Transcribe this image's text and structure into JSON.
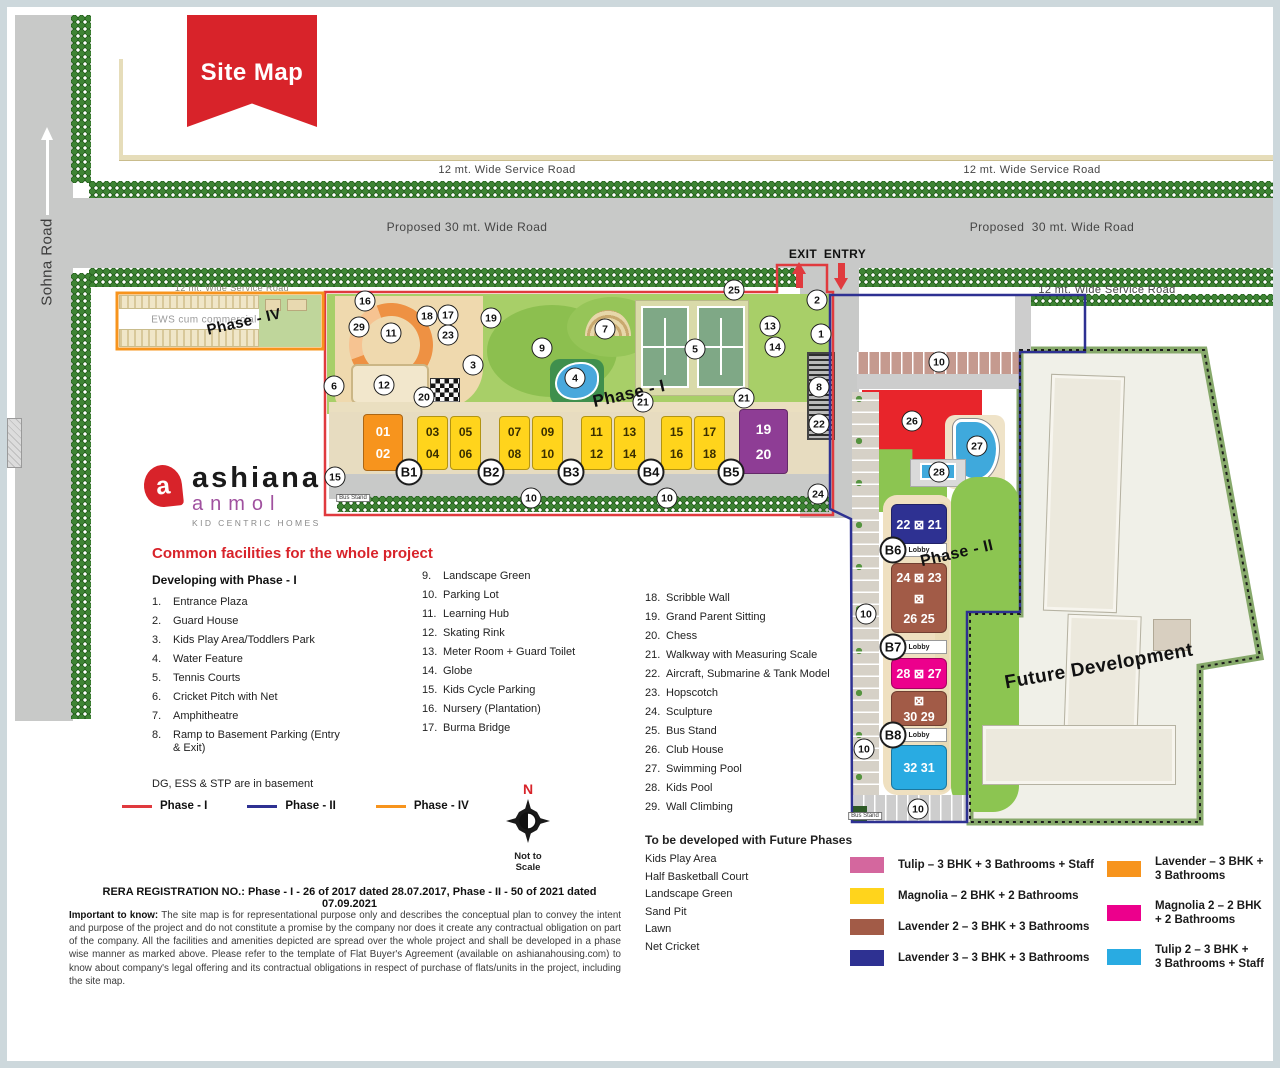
{
  "banner": {
    "title": "Site Map"
  },
  "colors": {
    "phase1_border": "#E03A3E",
    "phase2_border": "#2E3192",
    "phase4_border": "#F7941D",
    "road": "#C8C9C8",
    "club_house_red": "#E8252B",
    "pool_blue": "#3FA9DC"
  },
  "map": {
    "labels": [
      {
        "t": "12 mt. Wide Service Road",
        "x": 500,
        "y": 163,
        "s": 11,
        "c": "#454545"
      },
      {
        "t": "12 mt. Wide Service Road",
        "x": 1025,
        "y": 163,
        "s": 11,
        "c": "#454545"
      },
      {
        "t": "Proposed 30 mt. Wide Road",
        "x": 460,
        "y": 220,
        "s": 12,
        "c": "#454545"
      },
      {
        "t": "Proposed  30 mt. Wide Road",
        "x": 1045,
        "y": 220,
        "s": 12,
        "c": "#454545"
      },
      {
        "t": "12 mt. Wide Service Road",
        "x": 225,
        "y": 281,
        "s": 9,
        "c": "#8a8a76"
      },
      {
        "t": "12 mt. Wide Service Road",
        "x": 1100,
        "y": 283,
        "s": 11,
        "c": "#454545"
      },
      {
        "t": "Sohna Road",
        "x": 40,
        "y": 255,
        "s": 15,
        "c": "#3c3c3c",
        "rot": -90
      },
      {
        "t": "EXIT",
        "x": 796,
        "y": 247,
        "s": 12,
        "c": "#111",
        "w": 800
      },
      {
        "t": "ENTRY",
        "x": 838,
        "y": 247,
        "s": 12,
        "c": "#111",
        "w": 800
      },
      {
        "t": "EWS cum commercial",
        "x": 197,
        "y": 313,
        "s": 10,
        "c": "#9a9a9a"
      },
      {
        "t": "Phase - IV",
        "x": 237,
        "y": 315,
        "s": 15,
        "c": "#111",
        "rot": -13,
        "w": 800
      },
      {
        "t": "Phase - I",
        "x": 622,
        "y": 387,
        "s": 17,
        "c": "#111",
        "rot": -13,
        "w": 800
      },
      {
        "t": "Phase - II",
        "x": 950,
        "y": 547,
        "s": 16,
        "c": "#111",
        "rot": -13,
        "w": 800
      },
      {
        "t": "Future Development",
        "x": 1092,
        "y": 660,
        "s": 19,
        "c": "#111",
        "rot": -10,
        "w": 800
      },
      {
        "t": "Bus Stand",
        "x": 346,
        "y": 491,
        "s": 6,
        "c": "#333",
        "box": true
      },
      {
        "t": "Bus Stand",
        "x": 858,
        "y": 809,
        "s": 6,
        "c": "#333",
        "box": true
      }
    ],
    "circles": [
      {
        "n": "16",
        "x": 358,
        "y": 294
      },
      {
        "n": "29",
        "x": 352,
        "y": 320
      },
      {
        "n": "11",
        "x": 384,
        "y": 326
      },
      {
        "n": "18",
        "x": 420,
        "y": 309
      },
      {
        "n": "17",
        "x": 441,
        "y": 308
      },
      {
        "n": "23",
        "x": 441,
        "y": 328
      },
      {
        "n": "19",
        "x": 484,
        "y": 311
      },
      {
        "n": "3",
        "x": 466,
        "y": 358
      },
      {
        "n": "6",
        "x": 327,
        "y": 379
      },
      {
        "n": "12",
        "x": 377,
        "y": 378
      },
      {
        "n": "20",
        "x": 417,
        "y": 390
      },
      {
        "n": "15",
        "x": 328,
        "y": 470
      },
      {
        "n": "7",
        "x": 598,
        "y": 322
      },
      {
        "n": "9",
        "x": 535,
        "y": 341
      },
      {
        "n": "4",
        "x": 568,
        "y": 371
      },
      {
        "n": "5",
        "x": 688,
        "y": 342
      },
      {
        "n": "25",
        "x": 727,
        "y": 283
      },
      {
        "n": "13",
        "x": 763,
        "y": 319
      },
      {
        "n": "14",
        "x": 768,
        "y": 340
      },
      {
        "n": "2",
        "x": 810,
        "y": 293
      },
      {
        "n": "1",
        "x": 814,
        "y": 327
      },
      {
        "n": "8",
        "x": 812,
        "y": 380
      },
      {
        "n": "21",
        "x": 636,
        "y": 395
      },
      {
        "n": "21",
        "x": 737,
        "y": 391
      },
      {
        "n": "22",
        "x": 812,
        "y": 417
      },
      {
        "n": "24",
        "x": 811,
        "y": 487
      },
      {
        "n": "10",
        "x": 524,
        "y": 491
      },
      {
        "n": "10",
        "x": 660,
        "y": 491
      },
      {
        "n": "10",
        "x": 932,
        "y": 355
      },
      {
        "n": "10",
        "x": 859,
        "y": 607
      },
      {
        "n": "10",
        "x": 857,
        "y": 742
      },
      {
        "n": "10",
        "x": 911,
        "y": 802
      },
      {
        "n": "26",
        "x": 905,
        "y": 414
      },
      {
        "n": "27",
        "x": 970,
        "y": 439
      },
      {
        "n": "28",
        "x": 932,
        "y": 465
      }
    ],
    "bcircles": [
      {
        "n": "B1",
        "x": 402,
        "y": 465
      },
      {
        "n": "B2",
        "x": 484,
        "y": 465
      },
      {
        "n": "B3",
        "x": 564,
        "y": 465
      },
      {
        "n": "B4",
        "x": 644,
        "y": 465
      },
      {
        "n": "B5",
        "x": 724,
        "y": 465
      },
      {
        "n": "B6",
        "x": 886,
        "y": 543
      },
      {
        "n": "B7",
        "x": 886,
        "y": 640
      },
      {
        "n": "B8",
        "x": 886,
        "y": 728
      }
    ],
    "towers_phase1": [
      {
        "x": 356,
        "y": 407,
        "w": 40,
        "h": 57,
        "bg": "#F7941D",
        "fg": "#ffffff",
        "fs": 13,
        "labels": [
          "01",
          "02"
        ]
      },
      {
        "x": 410,
        "y": 409,
        "w": 31,
        "h": 54,
        "bg": "#FFD41C",
        "fg": "#3a2f00",
        "fs": 12,
        "labels": [
          "03",
          "04"
        ]
      },
      {
        "x": 443,
        "y": 409,
        "w": 31,
        "h": 54,
        "bg": "#FFD41C",
        "fg": "#3a2f00",
        "fs": 12,
        "labels": [
          "05",
          "06"
        ]
      },
      {
        "x": 492,
        "y": 409,
        "w": 31,
        "h": 54,
        "bg": "#FFD41C",
        "fg": "#3a2f00",
        "fs": 12,
        "labels": [
          "07",
          "08"
        ]
      },
      {
        "x": 525,
        "y": 409,
        "w": 31,
        "h": 54,
        "bg": "#FFD41C",
        "fg": "#3a2f00",
        "fs": 12,
        "labels": [
          "09",
          "10"
        ]
      },
      {
        "x": 574,
        "y": 409,
        "w": 31,
        "h": 54,
        "bg": "#FFD41C",
        "fg": "#3a2f00",
        "fs": 12,
        "labels": [
          "11",
          "12"
        ]
      },
      {
        "x": 607,
        "y": 409,
        "w": 31,
        "h": 54,
        "bg": "#FFD41C",
        "fg": "#3a2f00",
        "fs": 12,
        "labels": [
          "13",
          "14"
        ]
      },
      {
        "x": 654,
        "y": 409,
        "w": 31,
        "h": 54,
        "bg": "#FFD41C",
        "fg": "#3a2f00",
        "fs": 12,
        "labels": [
          "15",
          "16"
        ]
      },
      {
        "x": 687,
        "y": 409,
        "w": 31,
        "h": 54,
        "bg": "#FFD41C",
        "fg": "#3a2f00",
        "fs": 12,
        "labels": [
          "17",
          "18"
        ]
      },
      {
        "x": 732,
        "y": 402,
        "w": 49,
        "h": 65,
        "bg": "#8E3D95",
        "fg": "#ffffff",
        "fs": 14,
        "labels": [
          "19",
          "20"
        ]
      }
    ],
    "cores_x": [
      396,
      474,
      556,
      638,
      718
    ],
    "towers_phase2": [
      {
        "y": 497,
        "h": 40,
        "bg": "#2E3192",
        "rows": [
          "22 ⊠ 21"
        ]
      },
      {
        "y": 556,
        "h": 70,
        "bg": "#A25B47",
        "rows": [
          "24 ⊠ 23",
          "⊠",
          "26  25"
        ]
      },
      {
        "y": 651,
        "h": 31,
        "bg": "#EC008C",
        "rows": [
          "28 ⊠ 27"
        ]
      },
      {
        "y": 684,
        "h": 35,
        "bg": "#A25B47",
        "rows": [
          "⊠",
          "30  29"
        ]
      },
      {
        "y": 738,
        "h": 45,
        "bg": "#29ABE2",
        "rows": [
          "32  31"
        ]
      }
    ],
    "lobbies": [
      {
        "y": 536,
        "label": "Lobby"
      },
      {
        "y": 633,
        "label": "Lobby"
      },
      {
        "y": 721,
        "label": "Lobby"
      }
    ]
  },
  "facilities": {
    "title": "Common facilities for the whole project",
    "col1_header": "Developing with Phase - I",
    "col1": [
      {
        "n": "1.",
        "t": "Entrance Plaza"
      },
      {
        "n": "2.",
        "t": "Guard House"
      },
      {
        "n": "3.",
        "t": "Kids Play Area/Toddlers Park"
      },
      {
        "n": "4.",
        "t": "Water Feature"
      },
      {
        "n": "5.",
        "t": "Tennis Courts"
      },
      {
        "n": "6.",
        "t": "Cricket Pitch with Net"
      },
      {
        "n": "7.",
        "t": "Amphitheatre"
      },
      {
        "n": "8.",
        "t": "Ramp to Basement Parking (Entry & Exit)"
      }
    ],
    "col2": [
      {
        "n": "9.",
        "t": "Landscape Green"
      },
      {
        "n": "10.",
        "t": "Parking Lot"
      },
      {
        "n": "11.",
        "t": "Learning Hub"
      },
      {
        "n": "12.",
        "t": "Skating Rink"
      },
      {
        "n": "13.",
        "t": "Meter Room + Guard Toilet"
      },
      {
        "n": "14.",
        "t": "Globe"
      },
      {
        "n": "15.",
        "t": "Kids Cycle Parking"
      },
      {
        "n": "16.",
        "t": "Nursery (Plantation)"
      },
      {
        "n": "17.",
        "t": "Burma Bridge"
      }
    ],
    "col3": [
      {
        "n": "18.",
        "t": "Scribble Wall"
      },
      {
        "n": "19.",
        "t": "Grand Parent Sitting"
      },
      {
        "n": "20.",
        "t": "Chess"
      },
      {
        "n": "21.",
        "t": "Walkway with Measuring Scale"
      },
      {
        "n": "22.",
        "t": "Aircraft, Submarine & Tank Model"
      },
      {
        "n": "23.",
        "t": "Hopscotch"
      },
      {
        "n": "24.",
        "t": "Sculpture"
      },
      {
        "n": "25.",
        "t": "Bus Stand"
      },
      {
        "n": "26.",
        "t": "Club House"
      },
      {
        "n": "27.",
        "t": "Swimming Pool"
      },
      {
        "n": "28.",
        "t": "Kids Pool"
      },
      {
        "n": "29.",
        "t": "Wall Climbing"
      }
    ],
    "basement_note": "DG, ESS & STP are in basement"
  },
  "phase_lines": [
    {
      "label": "Phase - I",
      "color": "#E03A3E"
    },
    {
      "label": "Phase - II",
      "color": "#2E3192"
    },
    {
      "label": "Phase - IV",
      "color": "#F7941D"
    }
  ],
  "future_phases": {
    "header": "To be developed with Future Phases",
    "items": [
      "Kids Play Area",
      "Half Basketball Court",
      "Landscape Green",
      "Sand Pit",
      "Lawn",
      "Net Cricket"
    ]
  },
  "unit_legend": {
    "left": [
      {
        "color": "#D4679E",
        "label": "Tulip – 3 BHK + 3 Bathrooms + Staff"
      },
      {
        "color": "#FFD41C",
        "label": "Magnolia – 2 BHK + 2 Bathrooms"
      },
      {
        "color": "#A25B47",
        "label": "Lavender 2 – 3 BHK + 3 Bathrooms"
      },
      {
        "color": "#2E3192",
        "label": "Lavender 3 – 3 BHK + 3 Bathrooms"
      }
    ],
    "right": [
      {
        "color": "#F7941D",
        "label": "Lavender – 3 BHK +\n3 Bathrooms"
      },
      {
        "color": "#EC008C",
        "label": "Magnolia 2 – 2 BHK\n+ 2 Bathrooms"
      },
      {
        "color": "#29ABE2",
        "label": "Tulip 2 – 3 BHK +\n3 Bathrooms + Staff"
      }
    ]
  },
  "logo": {
    "mark": "a",
    "brand": "ashiana",
    "sub": "anmol",
    "tagline": "KID CENTRIC HOMES"
  },
  "compass": {
    "n": "N",
    "note": "Not to Scale"
  },
  "rera": "RERA REGISTRATION NO.: Phase - I - 26 of 2017 dated 28.07.2017, Phase - II - 50 of 2021 dated 07.09.2021",
  "disclaimer": {
    "lead": "Important to know:",
    "body": " The site map is for representational purpose only and describes the conceptual plan to convey the intent and purpose of the project and do not constitute a promise by the company nor does it create any contractual obligation on part of the company. All the facilities and amenities depicted are spread over the whole project and shall be developed in a phase wise manner as marked above. Please refer to the template of Flat Buyer's Agreement (available on ashianahousing.com) to know about company's legal offering and its contractual obligations in respect of purchase of flats/units in the project, including the site map."
  }
}
